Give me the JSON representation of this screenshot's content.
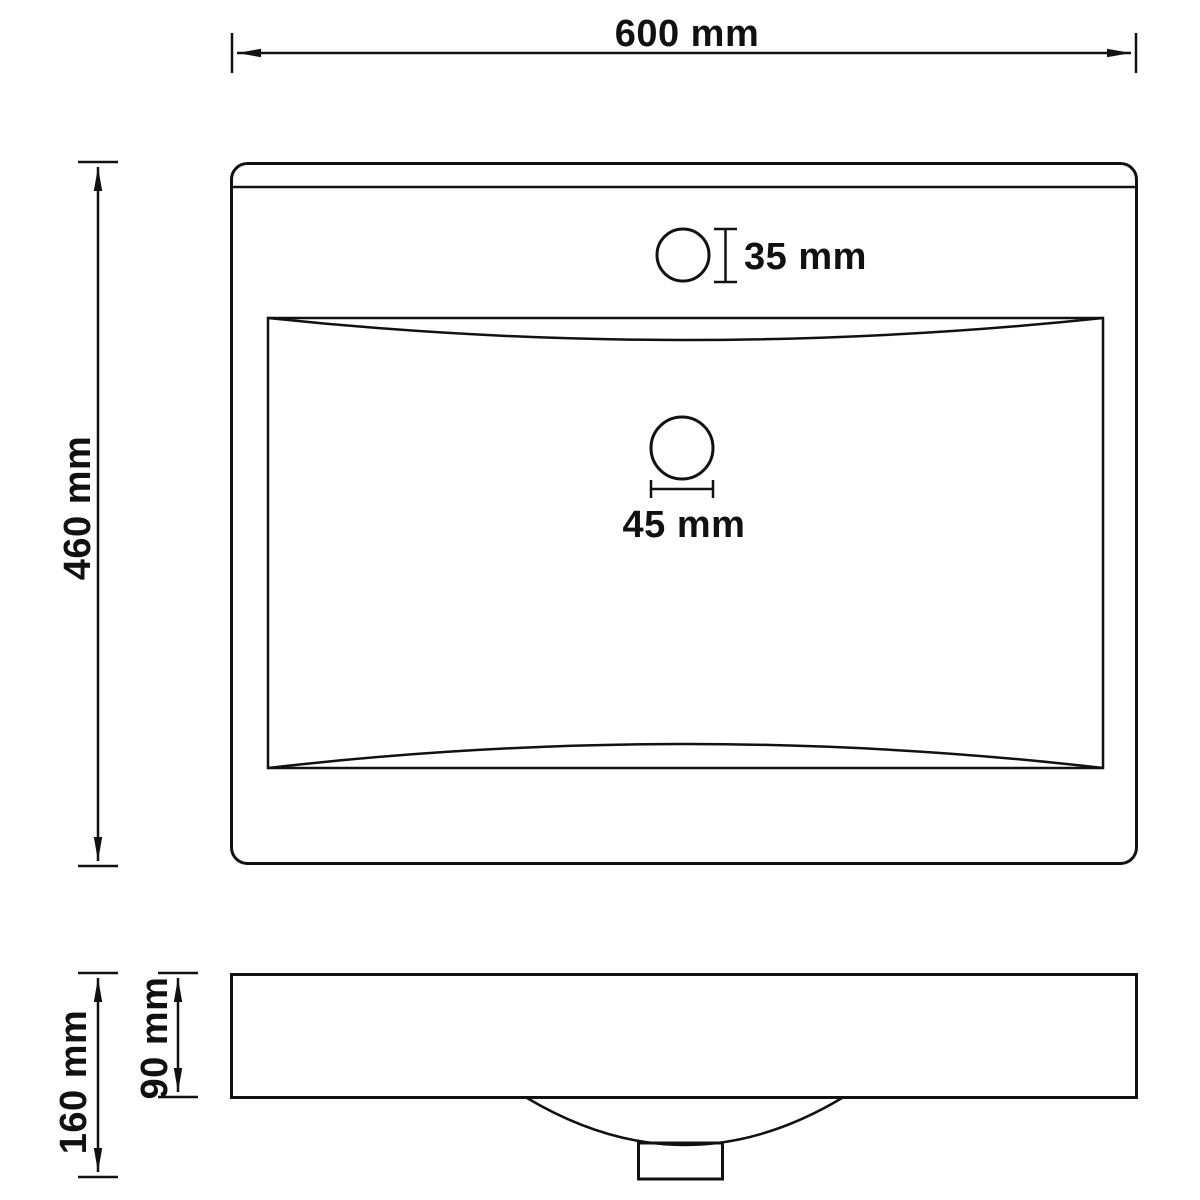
{
  "colors": {
    "line": "#111111",
    "background": "#ffffff"
  },
  "drawing": {
    "views": {
      "top": {
        "width_label": "600 mm",
        "height_label": "460 mm",
        "faucet_hole_label": "35 mm",
        "drain_hole_label": "45 mm"
      },
      "side": {
        "total_height_label": "160 mm",
        "basin_depth_label": "90 mm"
      }
    }
  }
}
